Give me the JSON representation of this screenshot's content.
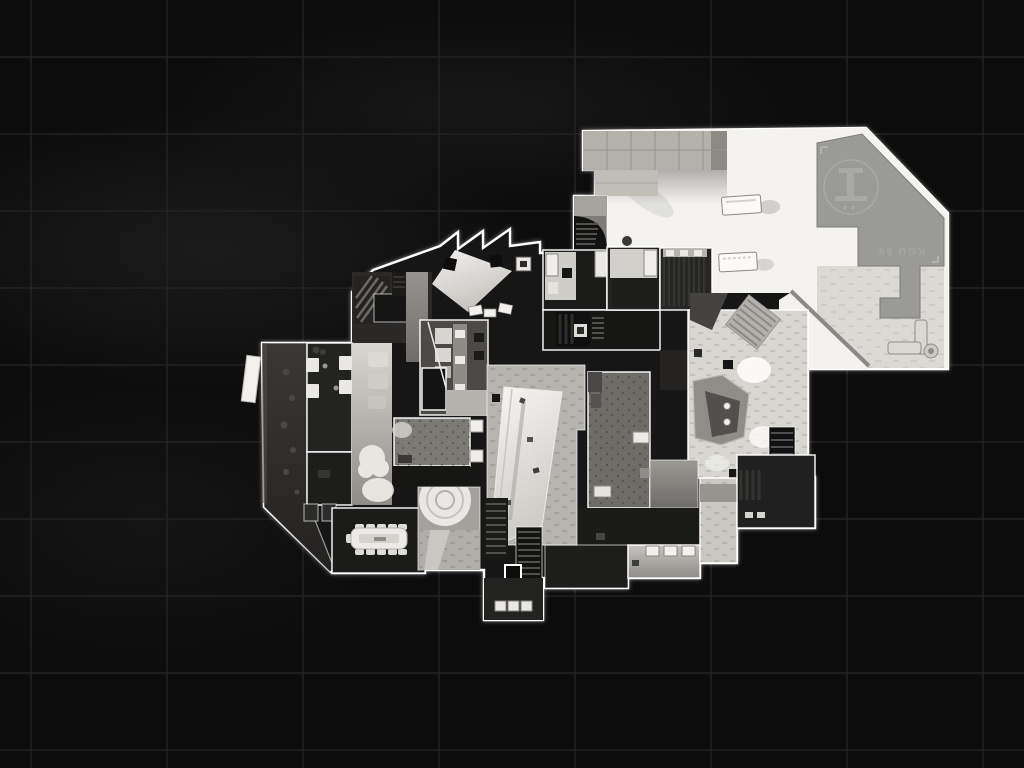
{
  "scene": {
    "kind": "game tactical map overview (top-down building floor plan)",
    "background": {
      "base": "#0c0c0c",
      "grid": "#222222",
      "haze": "#3a3a3a"
    },
    "map": {
      "outline": "#ffffff",
      "floor_bright": "#f4f3ef",
      "floor_tile": "#d8d6d1",
      "floor_dark": "#1b1b1a",
      "concrete": "#b4b1ab",
      "helipad": {
        "deck": "#9a9a97",
        "marking": "#a9a9a6",
        "label": "KGU 69"
      }
    }
  }
}
